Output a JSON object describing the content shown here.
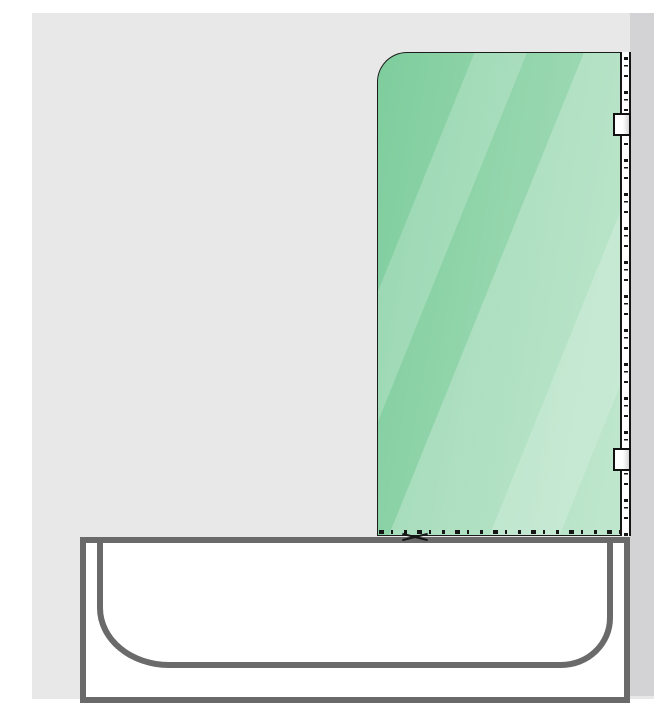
{
  "document": {
    "type": "technical-diagram",
    "subject": "hinged glass bath screen mounted on wall profile above a bathtub, side elevation"
  },
  "colors": {
    "page_bg": "#ffffff",
    "wall": "#e8e8e8",
    "wall_return": "#d3d3d6",
    "tub_stroke": "#6a6a6a",
    "tub_fill": "#ffffff",
    "glass_dark": "#7ecd9d",
    "glass_mid": "#93d5ac",
    "glass_light": "#a9debc",
    "glass_edge": "#1c1c1c",
    "profile_stroke": "#161616",
    "hinge_stroke": "#111111",
    "hinge_fill": "#ffffff"
  },
  "elements": {
    "wall": "tiled wall background",
    "wall_return": "side wall return strip",
    "glass_panel": "green glass screen with rounded top-left corner and diagonal reflections",
    "wall_profile": "wall mounting profile with fixing marks",
    "hinge_top": "upper hinge block",
    "hinge_bottom": "lower hinge block",
    "bottom_seal": "dashed bottom seal on tub rim",
    "fixing_mark": "cross mark at panel base",
    "bathtub": "bathtub apron with rounded inner basin"
  }
}
